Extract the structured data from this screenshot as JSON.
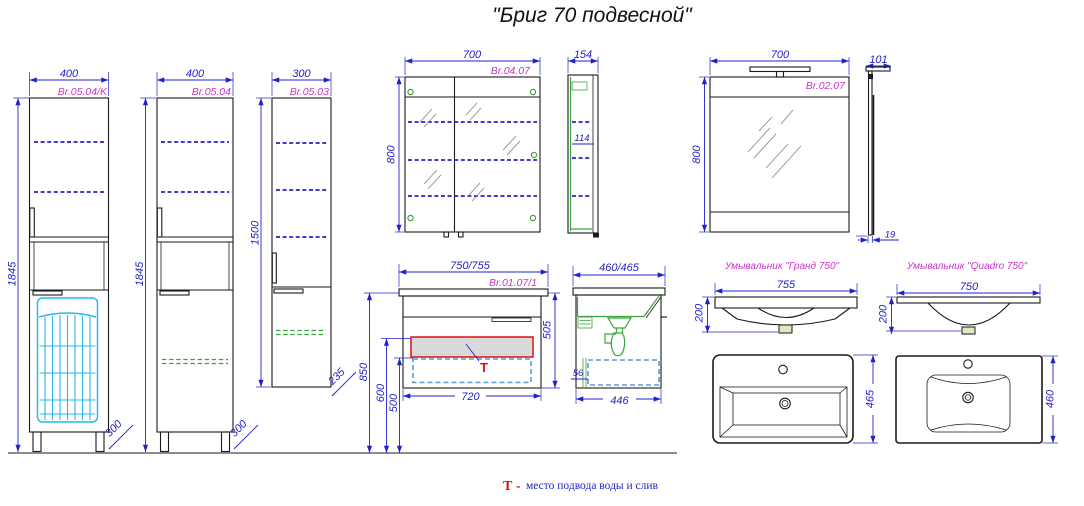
{
  "title": "\"Бриг 70 подвесной\"",
  "drawings": {
    "tall_k": {
      "code": "Br.05.04/K",
      "dims": {
        "width": "400",
        "height": "1845",
        "depth": "300"
      }
    },
    "tall": {
      "code": "Br.05.04",
      "dims": {
        "width": "400",
        "height": "1845",
        "depth": "300"
      }
    },
    "small": {
      "code": "Br.05.03",
      "dims": {
        "width": "300",
        "height": "1500",
        "depth": "235"
      }
    },
    "mirror_cab": {
      "code": "Br.04.07",
      "dims": {
        "width": "700",
        "height": "800",
        "side_depth": "154",
        "inner_depth": "114"
      }
    },
    "mirror": {
      "code": "Br.02.07",
      "dims": {
        "width": "700",
        "height": "800",
        "side_depth": "101",
        "panel": "19"
      }
    },
    "vanity": {
      "code": "Br.01.07/1",
      "dims": {
        "width": "750/755",
        "height_floor": "850",
        "height_supply": "600",
        "height_drain": "500",
        "body_height": "505",
        "body_width": "720",
        "side_width": "460/465",
        "side_bottom": "446",
        "side_gap": "56"
      },
      "marker": "Т"
    },
    "grand": {
      "name": "Умывальник \"Гранд 750\"",
      "dims": {
        "width": "755",
        "height": "200",
        "depth": "465"
      }
    },
    "quadro": {
      "name": "Умывальник \"Quadro 750\"",
      "dims": {
        "width": "750",
        "height": "200",
        "depth": "460"
      }
    }
  },
  "legend": {
    "marker": "Т -",
    "text": "место подвода воды и слив"
  },
  "colors": {
    "dimension": "#2222cc",
    "code": "#cc33cc",
    "green": "#3aa53a",
    "cyan": "#2cb8e8",
    "red": "#dd1111",
    "line": "#1a1a1a"
  }
}
